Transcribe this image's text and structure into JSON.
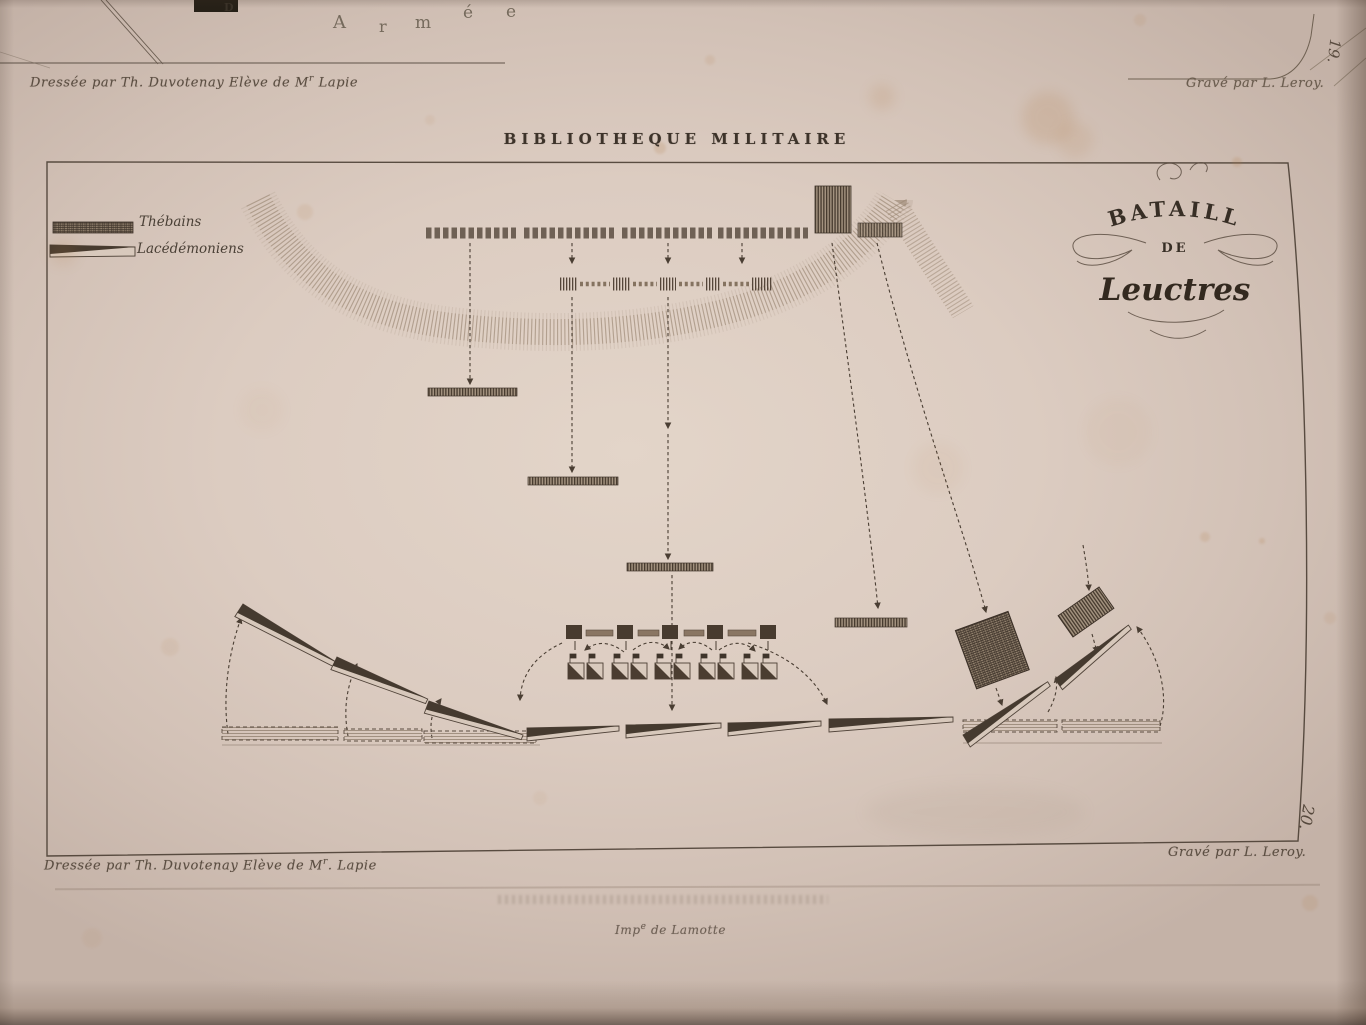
{
  "colors": {
    "paper": "#dcccc1",
    "ink": "#3f352b",
    "faded_ink": "#6b5d50"
  },
  "upper_plate": {
    "partial_word_letters": [
      "A",
      "r",
      "m",
      "é",
      "e"
    ],
    "fragment_letter": "D",
    "credit_left_main": "Dressée par Th. Duvotenay Elève de M",
    "credit_left_sup": "r",
    "credit_left_end": " Lapie",
    "credit_right": "Gravé par L. Leroy.",
    "plate_number": "19."
  },
  "plate": {
    "series_title": "BIBLIOTHEQUE MILITAIRE",
    "cartouche": {
      "line1": "BATAILLE",
      "line2": "DE",
      "line3": "Leuctres"
    },
    "legend": {
      "item1": "Thébains",
      "item2": "Lacédémoniens"
    },
    "credit_left_main": "Dressée par Th. Duvotenay Elève de M",
    "credit_left_sup": "r",
    "credit_left_end": ". Lapie",
    "credit_right": "Gravé par L. Leroy.",
    "plate_number": "20.",
    "imprint_main": "Imp",
    "imprint_sup": "e",
    "imprint_end": " de Lamotte"
  }
}
